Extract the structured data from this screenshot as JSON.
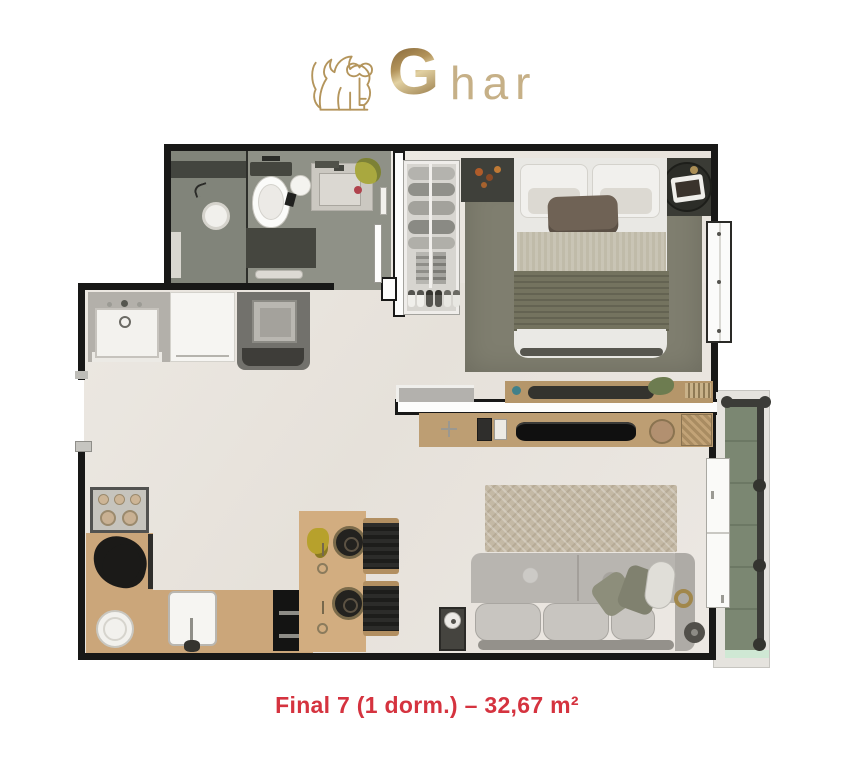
{
  "logo": {
    "lion_icon": "lion-with-key",
    "g": "G",
    "rest": "har",
    "gold": "#b2935a",
    "gold_light": "#c6b087"
  },
  "caption": {
    "text": "Final 7 (1 dorm.) – 32,67 m²",
    "color": "#d5333f"
  },
  "plan": {
    "areas": [
      "bathroom",
      "wardrobe",
      "bedroom",
      "hall",
      "living-dining-kitchen",
      "laundry",
      "balcony",
      "entry"
    ],
    "palette": {
      "wall": "#181817",
      "floor": "#ebe7e1",
      "bathroom_floor": "#8f9187",
      "bedroom_rug": "#7f7e6f",
      "living_rug": "#c4b9a5",
      "wood": "#cba67a",
      "sofa": "#b8b5b0",
      "balcony_tile": "#78846f"
    }
  }
}
